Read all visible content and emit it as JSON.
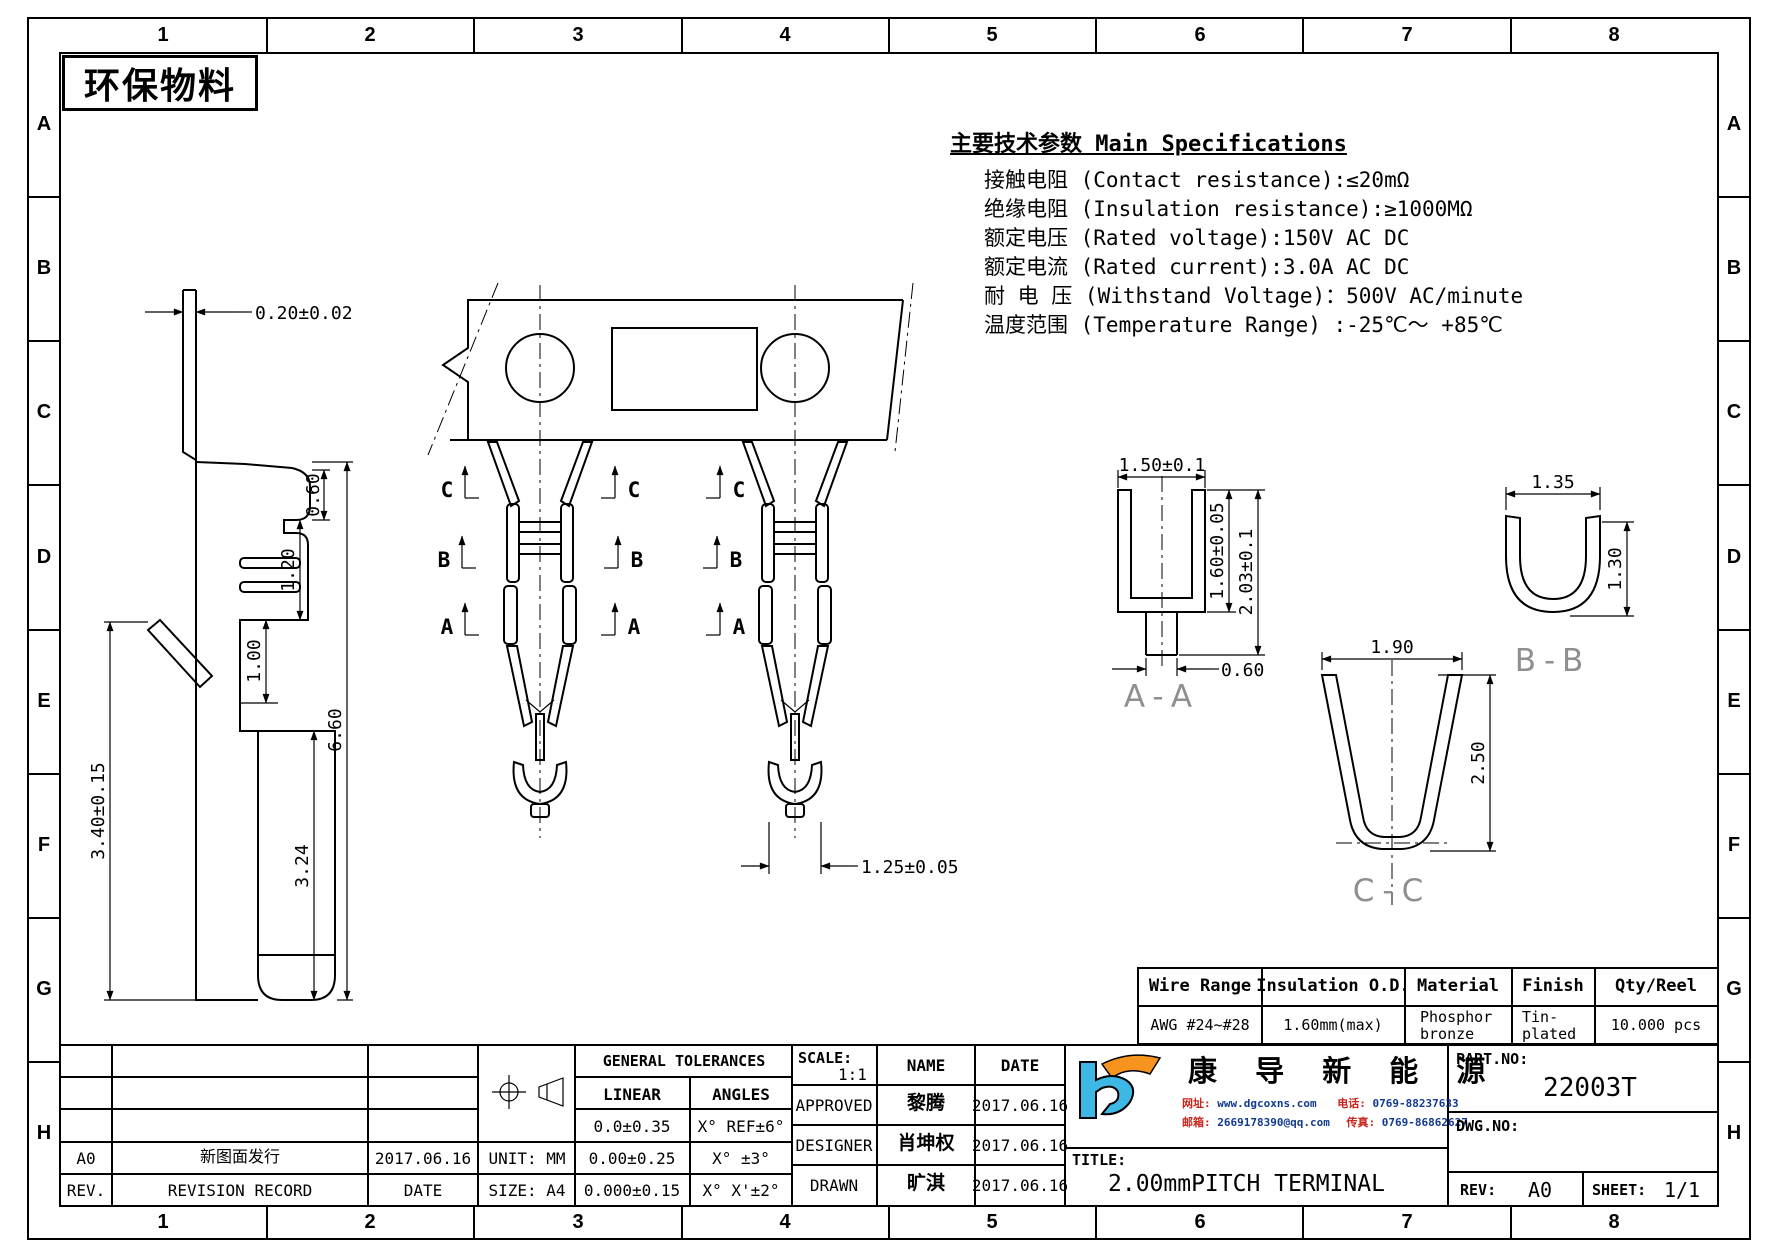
{
  "zones": {
    "cols": [
      "1",
      "2",
      "3",
      "4",
      "5",
      "6",
      "7",
      "8"
    ],
    "rows": [
      "A",
      "B",
      "C",
      "D",
      "E",
      "F",
      "G",
      "H"
    ]
  },
  "stamp": "环保物料",
  "specs": {
    "title": "主要技术参数 Main Specifications",
    "lines": [
      "接触电阻 (Contact resistance):≤20mΩ",
      "绝缘电阻 (Insulation resistance):≥1000MΩ",
      "额定电压 (Rated voltage):150V AC DC",
      "额定电流 (Rated current):3.0A AC DC",
      "耐 电 压 (Withstand Voltage)：500V AC/minute",
      "温度范围 (Temperature Range) :-25℃～ +85℃"
    ]
  },
  "side_view": {
    "pin_width": "0.20±0.02",
    "d060": "0.60",
    "d120": "1.20",
    "d660": "6.60",
    "d324": "3.24",
    "d100": "1.00",
    "d340": "3.40±0.15"
  },
  "center": {
    "section_labels": [
      "C",
      "B",
      "A"
    ],
    "pitch_dim": "1.25±0.05"
  },
  "section_aa": {
    "label": "A-A",
    "top_width": "1.50±0.1",
    "inner_height": "1.60±0.05",
    "total_height": "2.03±0.1",
    "stem_width": "0.60"
  },
  "section_bb": {
    "label": "B-B",
    "width": "1.35",
    "height": "1.30"
  },
  "section_cc": {
    "label": "C-C",
    "width": "1.90",
    "height": "2.50"
  },
  "parts_table": {
    "headers": [
      "Wire Range",
      "Insulation O.D.",
      "Material",
      "Finish",
      "Qty/Reel"
    ],
    "wire_range": "AWG #24~#28",
    "insulation_od": "1.60mm(max)",
    "material": [
      "Phosphor",
      "bronze"
    ],
    "finish": [
      "Tin-",
      "plated"
    ],
    "qty": "10.000 pcs"
  },
  "title_block": {
    "revision": {
      "rev": "A0",
      "record": "新图面发行",
      "date": "2017.06.16",
      "rev_label": "REV.",
      "record_label": "REVISION RECORD",
      "date_label": "DATE"
    },
    "unit_label": "UNIT: MM",
    "size_label": "SIZE: A4",
    "tolerances": {
      "title": "GENERAL TOLERANCES",
      "linear_label": "LINEAR",
      "angles_label": "ANGLES",
      "linear": [
        "0.0±0.35",
        "0.00±0.25",
        "0.000±0.15"
      ],
      "angles": [
        "X° REF±6°",
        "X° ±3°",
        "X° X'±2°"
      ]
    },
    "scale_label": "SCALE:",
    "scale": "1:1",
    "name_label": "NAME",
    "date_label": "DATE",
    "signoff": [
      {
        "role": "APPROVED",
        "name": "黎腾",
        "date": "2017.06.16"
      },
      {
        "role": "DESIGNER",
        "name": "肖坤权",
        "date": "2017.06.16"
      },
      {
        "role": "DRAWN",
        "name": "旷淇",
        "date": "2017.06.16"
      }
    ],
    "company": {
      "name": "康 导 新 能 源",
      "website_label": "网址:",
      "website": "www.dgcoxns.com",
      "phone_label": "电话:",
      "phone": "0769-88237633",
      "email_label": "邮箱:",
      "email": "2669178390@qq.com",
      "fax_label": "传真:",
      "fax": "0769-86862627"
    },
    "title_label": "TITLE:",
    "title": "2.00mmPITCH TERMINAL",
    "part_no_label": "PART.NO:",
    "part_no": "22003T",
    "dwg_no_label": "DWG.NO:",
    "rev_label": "REV:",
    "rev": "A0",
    "sheet_label": "SHEET:",
    "sheet": "1/1"
  }
}
